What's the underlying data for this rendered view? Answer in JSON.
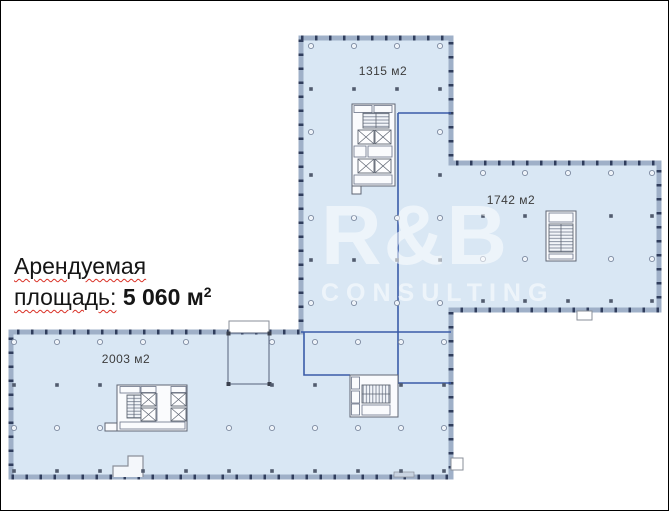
{
  "annotation": {
    "line1": "Арендуемая",
    "line2_word": "площадь:",
    "value": "5 060",
    "unit": "м",
    "sup": "2"
  },
  "areas": {
    "tower": {
      "label": "1315 м2"
    },
    "east_wing": {
      "label": "1742 м2"
    },
    "south_wing": {
      "label": "2003 м2"
    }
  },
  "watermark": {
    "line1": "R&B",
    "line2": "CONSULTING"
  },
  "colors": {
    "floor_fill": "#d9e7f4",
    "wall_base": "#9fb0c8",
    "wall_tick": "#2f3d5c",
    "demising_line": "#3b5ca8",
    "core_stroke": "#5f6673",
    "spellcheck_underline": "#d93025",
    "watermark_text": "#ffffff"
  },
  "column_grid": {
    "regions": [
      {
        "name": "tower",
        "cols": [
          310,
          353,
          396,
          439
        ],
        "rows": [
          45,
          88,
          131,
          174,
          217,
          259,
          302
        ]
      },
      {
        "name": "east-wing",
        "cols": [
          482,
          524,
          567,
          610,
          651
        ],
        "rows": [
          172,
          215,
          258,
          300
        ]
      },
      {
        "name": "south-wing",
        "cols": [
          13,
          56,
          99,
          142,
          185,
          228,
          271,
          314,
          357,
          400,
          443
        ],
        "rows": [
          341,
          384,
          427,
          470
        ]
      }
    ],
    "exclusions": [
      [
        349,
        100,
        48,
        90
      ],
      [
        543,
        208,
        34,
        54
      ],
      [
        114,
        380,
        74,
        52
      ],
      [
        347,
        372,
        52,
        46
      ],
      [
        225,
        318,
        45,
        68
      ]
    ]
  }
}
